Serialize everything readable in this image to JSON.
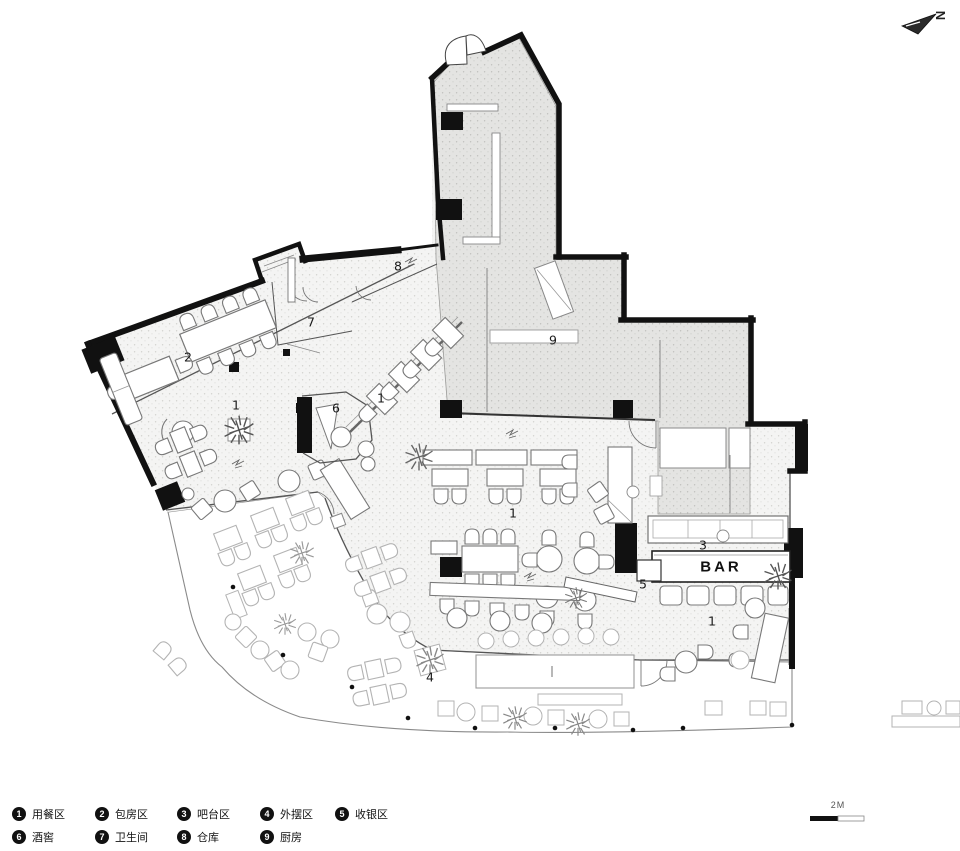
{
  "plan": {
    "north_label": "N",
    "bar_label": "BAR",
    "scale_label": "2M",
    "zone_labels": [
      "8",
      "7",
      "9",
      "2",
      "1",
      "1",
      "6",
      "1",
      "3",
      "5",
      "1",
      "4"
    ]
  },
  "legend": {
    "items": [
      {
        "num": "1",
        "label": "用餐区"
      },
      {
        "num": "2",
        "label": "包房区"
      },
      {
        "num": "3",
        "label": "吧台区"
      },
      {
        "num": "4",
        "label": "外摆区"
      },
      {
        "num": "5",
        "label": "收银区"
      },
      {
        "num": "6",
        "label": "酒窖"
      },
      {
        "num": "7",
        "label": "卫生间"
      },
      {
        "num": "8",
        "label": "仓库"
      },
      {
        "num": "9",
        "label": "厨房"
      }
    ]
  }
}
